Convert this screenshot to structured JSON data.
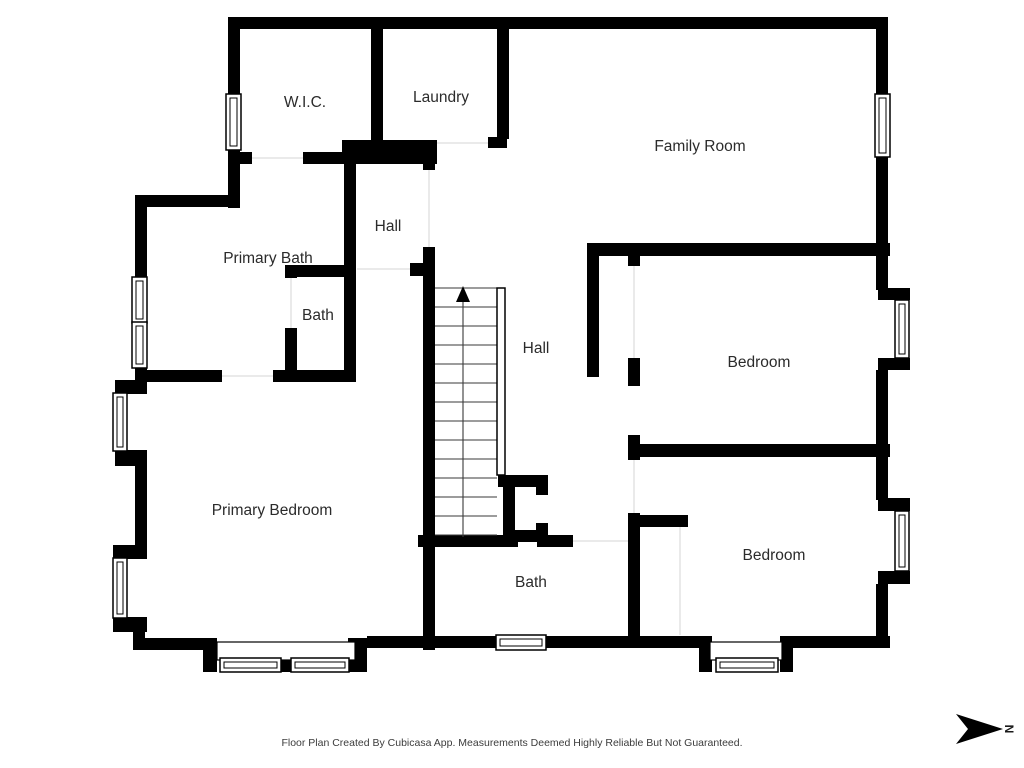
{
  "title": "Floor Plan",
  "rooms": [
    {
      "id": "wic",
      "label": "W.I.C."
    },
    {
      "id": "laundry",
      "label": "Laundry"
    },
    {
      "id": "family-room",
      "label": "Family Room"
    },
    {
      "id": "hall-upper",
      "label": "Hall"
    },
    {
      "id": "primary-bath",
      "label": "Primary Bath"
    },
    {
      "id": "bath-small",
      "label": "Bath"
    },
    {
      "id": "hall-center",
      "label": "Hall"
    },
    {
      "id": "bedroom-top",
      "label": "Bedroom"
    },
    {
      "id": "primary-bedroom",
      "label": "Primary Bedroom"
    },
    {
      "id": "bath-bottom",
      "label": "Bath"
    },
    {
      "id": "bedroom-bottom",
      "label": "Bedroom"
    }
  ],
  "stairs": {
    "direction": "up",
    "steps": 13
  },
  "compass": {
    "letter": "N",
    "points": "east"
  },
  "footer": {
    "disclaimer": "Floor Plan Created By Cubicasa App. Measurements Deemed Highly Reliable But Not Guaranteed."
  },
  "colors": {
    "wall": "#000000",
    "label": "#2b2b2b",
    "footer": "#3c3c3c",
    "background": "#ffffff"
  }
}
